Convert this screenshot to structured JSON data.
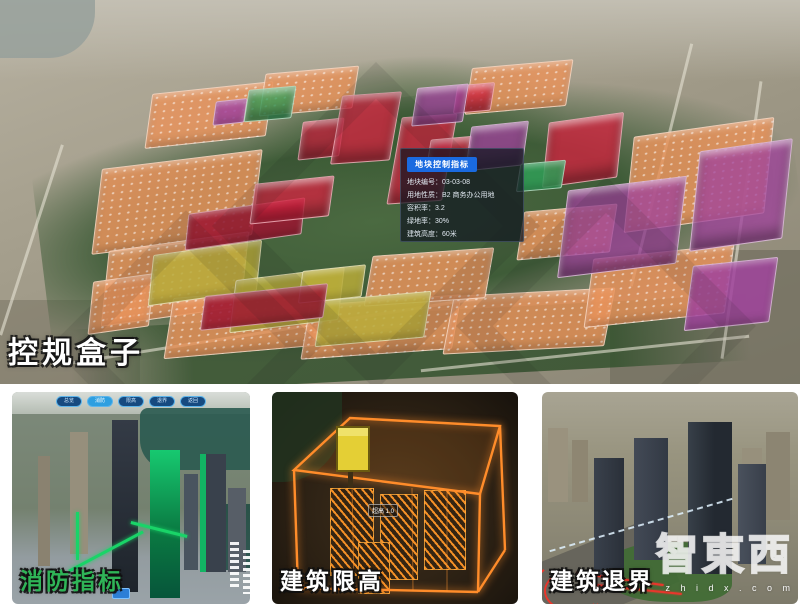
{
  "main_view": {
    "caption": "控规盒子",
    "tooltip": {
      "title": "地块控制指标",
      "rows": [
        {
          "label": "地块编号",
          "value": "03-03-08"
        },
        {
          "label": "用地性质",
          "value": "B2 商务办公用地"
        },
        {
          "label": "容积率",
          "value": "3.2"
        },
        {
          "label": "绿地率",
          "value": "30%"
        },
        {
          "label": "建筑高度",
          "value": "60米"
        }
      ]
    },
    "palette": {
      "salmon": "#e8935c",
      "red": "#d42340",
      "darkred": "#9c1430",
      "purple": "#a0439c",
      "green": "#2f9e57",
      "yellow": "#b9ac3a"
    },
    "blocks": [
      {
        "x": 148,
        "y": 88,
        "w": 120,
        "h": 52,
        "c": "salmon",
        "r": -6,
        "t": 0
      },
      {
        "x": 262,
        "y": 70,
        "w": 92,
        "h": 40,
        "c": "salmon",
        "r": -5,
        "t": 0
      },
      {
        "x": 468,
        "y": 64,
        "w": 100,
        "h": 44,
        "c": "salmon",
        "r": -5,
        "t": 0
      },
      {
        "x": 96,
        "y": 160,
        "w": 160,
        "h": 82,
        "c": "salmon",
        "r": -7,
        "t": 0
      },
      {
        "x": 104,
        "y": 242,
        "w": 140,
        "h": 72,
        "c": "salmon",
        "r": -8,
        "t": 0
      },
      {
        "x": 168,
        "y": 292,
        "w": 150,
        "h": 58,
        "c": "salmon",
        "r": -5,
        "t": 0
      },
      {
        "x": 305,
        "y": 300,
        "w": 150,
        "h": 52,
        "c": "salmon",
        "r": -4,
        "t": 0
      },
      {
        "x": 448,
        "y": 292,
        "w": 160,
        "h": 56,
        "c": "salmon",
        "r": -3,
        "t": 0
      },
      {
        "x": 588,
        "y": 252,
        "w": 140,
        "h": 66,
        "c": "salmon",
        "r": -6,
        "t": 0
      },
      {
        "x": 628,
        "y": 128,
        "w": 140,
        "h": 92,
        "c": "salmon",
        "r": -8,
        "t": 0
      },
      {
        "x": 368,
        "y": 252,
        "w": 120,
        "h": 48,
        "c": "salmon",
        "r": -4,
        "t": 0
      },
      {
        "x": 520,
        "y": 208,
        "w": 92,
        "h": 46,
        "c": "salmon",
        "r": -5,
        "t": 0
      },
      {
        "x": 90,
        "y": 278,
        "w": 60,
        "h": 50,
        "c": "salmon",
        "r": -8,
        "t": 0
      },
      {
        "x": 150,
        "y": 248,
        "w": 108,
        "h": 48,
        "c": "yellow",
        "r": -8,
        "t": 0
      },
      {
        "x": 232,
        "y": 274,
        "w": 108,
        "h": 50,
        "c": "yellow",
        "r": -7,
        "t": 0
      },
      {
        "x": 300,
        "y": 268,
        "w": 62,
        "h": 30,
        "c": "yellow",
        "r": -6,
        "t": 0
      },
      {
        "x": 318,
        "y": 296,
        "w": 108,
        "h": 44,
        "c": "yellow",
        "r": -5,
        "t": 0
      },
      {
        "x": 186,
        "y": 206,
        "w": 116,
        "h": 34,
        "c": "darkred",
        "r": -8,
        "t": 0
      },
      {
        "x": 202,
        "y": 290,
        "w": 122,
        "h": 32,
        "c": "darkred",
        "r": -6,
        "t": 0
      },
      {
        "x": 252,
        "y": 180,
        "w": 78,
        "h": 38,
        "c": "red",
        "r": -6,
        "t": 1
      },
      {
        "x": 300,
        "y": 120,
        "w": 40,
        "h": 36,
        "c": "red",
        "r": -6,
        "t": 1
      },
      {
        "x": 336,
        "y": 94,
        "w": 58,
        "h": 66,
        "c": "red",
        "r": -4,
        "t": 1
      },
      {
        "x": 394,
        "y": 116,
        "w": 54,
        "h": 84,
        "c": "red",
        "r": -4,
        "t": 1
      },
      {
        "x": 428,
        "y": 138,
        "w": 40,
        "h": 30,
        "c": "red",
        "r": -5,
        "t": 1
      },
      {
        "x": 455,
        "y": 84,
        "w": 36,
        "h": 26,
        "c": "red",
        "r": -5,
        "t": 1
      },
      {
        "x": 545,
        "y": 118,
        "w": 74,
        "h": 62,
        "c": "red",
        "r": -8,
        "t": 1
      },
      {
        "x": 214,
        "y": 100,
        "w": 30,
        "h": 22,
        "c": "purple",
        "r": -6,
        "t": 0
      },
      {
        "x": 414,
        "y": 86,
        "w": 50,
        "h": 36,
        "c": "purple",
        "r": -5,
        "t": 1
      },
      {
        "x": 468,
        "y": 124,
        "w": 56,
        "h": 42,
        "c": "purple",
        "r": -6,
        "t": 1
      },
      {
        "x": 562,
        "y": 184,
        "w": 118,
        "h": 84,
        "c": "purple",
        "r": -7,
        "t": 1
      },
      {
        "x": 694,
        "y": 146,
        "w": 92,
        "h": 96,
        "c": "purple",
        "r": -8,
        "t": 1
      },
      {
        "x": 688,
        "y": 262,
        "w": 84,
        "h": 62,
        "c": "purple",
        "r": -6,
        "t": 0
      },
      {
        "x": 246,
        "y": 88,
        "w": 46,
        "h": 30,
        "c": "green",
        "r": -5,
        "t": 1
      },
      {
        "x": 518,
        "y": 162,
        "w": 44,
        "h": 26,
        "c": "green",
        "r": -5,
        "t": 0
      }
    ]
  },
  "thumbnails": {
    "fire": {
      "caption": "消防指标",
      "caption_color": "#2fb457",
      "buttons": [
        "总览",
        "消防",
        "限高",
        "退界",
        "返回"
      ],
      "active_button_index": 1,
      "route_color": "#19d468"
    },
    "height": {
      "caption": "建筑限高",
      "tag": "超高 1.0",
      "frame_color": "#ff8c2a"
    },
    "setback": {
      "caption": "建筑退界",
      "line_color": "#e8372c"
    }
  },
  "watermark": {
    "text": "智東西",
    "subtext": "z h i d x . c o m"
  }
}
